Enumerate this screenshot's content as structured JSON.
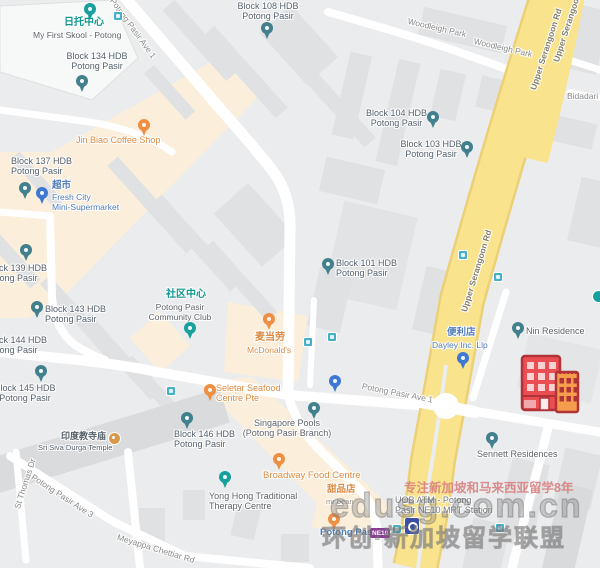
{
  "map": {
    "watermark": {
      "line1": "专注新加坡和马来西亚留学8年",
      "line2": "edusg.com.cn",
      "line3": "环创·新加坡留学联盟"
    },
    "roads": {
      "upper_serangoon": "Upper Serangoon Rd",
      "woodleigh_park": "Woodleigh Park",
      "potong_pasir_ave_1": "Potong Pasir Ave 1",
      "potong_pasir_ave_3": "Potong Pasir Ave 3",
      "meyappa_chettiar_rd": "Meyappa Chettiar Rd",
      "st_thomas_dr": "St Thomas Dr",
      "bidadari_park": "Bidadari Pa"
    },
    "transit": {
      "station_name": "Potong Pasir",
      "line_badge": "NE10"
    },
    "pois": {
      "first_skool": {
        "cjk": "日托中心",
        "en": "My First Skool - Potong"
      },
      "jin_biao": {
        "en": "Jin Biao Coffee Shop"
      },
      "fresh_city": {
        "cjk": "超市",
        "en1": "Fresh City",
        "en2": "Mini-Supermarket"
      },
      "community_club": {
        "cjk": "社区中心",
        "en1": "Potong Pasir",
        "en2": "Community Club"
      },
      "mcdonalds": {
        "cjk": "麦当劳",
        "en": "McDonald's"
      },
      "seletar_seafood": {
        "en1": "Seletar Seafood",
        "en2": "Centre Pte"
      },
      "singapore_pools": {
        "en1": "Singapore Pools",
        "en2": "(Potong Pasir Branch)"
      },
      "broadway": {
        "en": "Broadway Food Centre"
      },
      "yong_hong": {
        "en1": "Yong Hong Traditional",
        "en2": "Therapy Centre"
      },
      "mr_bean": {
        "cjk": "甜品店",
        "en": "mr bean"
      },
      "temple": {
        "cjk": "印度教寺庙",
        "en": "Sri Siva Durga Temple"
      },
      "dayley": {
        "cjk": "便利店",
        "en": "Dayley Inc. Llp"
      },
      "uob_atm": {
        "en1": "UOB ATM - Potong",
        "en2": "Pasir NE10 MRT Station"
      },
      "nin_residence": {
        "en": "Nin Residence"
      },
      "sennett_residences": {
        "en": "Sennett Residences"
      }
    },
    "blocks": {
      "b101": {
        "l1": "Block 101 HDB",
        "l2": "Potong Pasir"
      },
      "b103": {
        "l1": "Block 103 HDB",
        "l2": "Potong Pasir"
      },
      "b104": {
        "l1": "Block 104 HDB",
        "l2": "Potong Pasir"
      },
      "b108": {
        "l1": "Block 108 HDB",
        "l2": "Potong Pasir"
      },
      "b134": {
        "l1": "Block 134 HDB",
        "l2": "Potong Pasir"
      },
      "b137": {
        "l1": "Block 137 HDB",
        "l2": "Potong Pasir"
      },
      "b139": {
        "l1": "Block 139 HDB",
        "l2": "Potong Pasir"
      },
      "b143": {
        "l1": "Block 143 HDB",
        "l2": "Potong Pasir"
      },
      "b144": {
        "l1": "Block 144 HDB",
        "l2": "Potong Pasir"
      },
      "b145": {
        "l1": "Block 145 HDB",
        "l2": "Potong Pasir"
      },
      "b146": {
        "l1": "Block 146 HDB",
        "l2": "Potong Pasir"
      }
    },
    "colors": {
      "major_road": "#f9e38c",
      "commercial_area": "#fbeedb",
      "poi_orange": "#dd8a42",
      "poi_teal": "#0f968e",
      "poi_blue": "#4f7cba",
      "hdb_text": "#55606b",
      "ne_line_purple": "#8a3d94",
      "marker_red": "#ea4d52",
      "marker_orange": "#f59c4d"
    }
  }
}
